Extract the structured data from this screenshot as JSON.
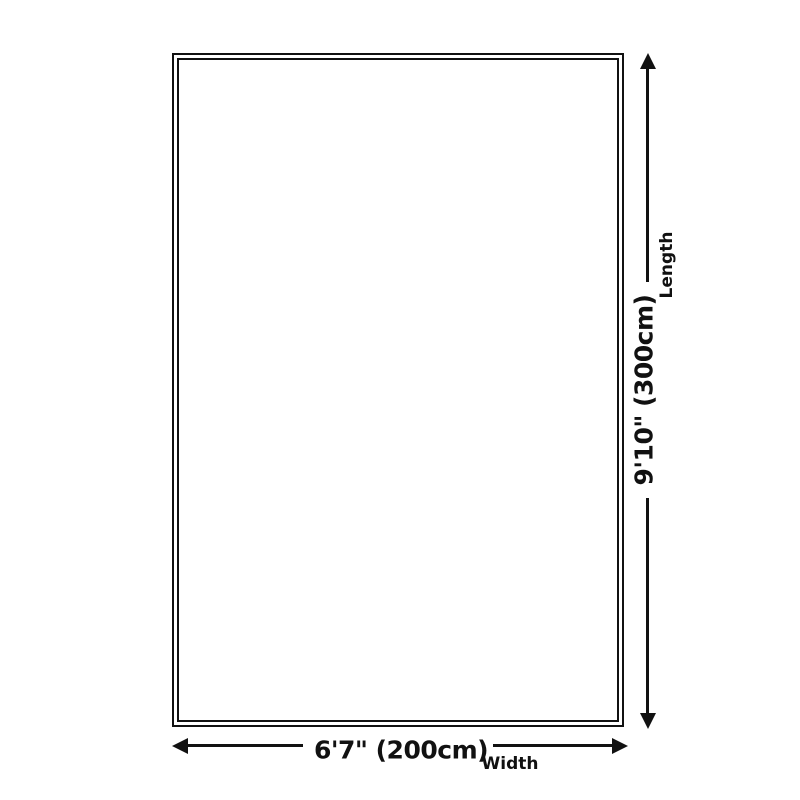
{
  "diagram": {
    "length": {
      "value": "9'10\" (300cm)",
      "label": "Length"
    },
    "width": {
      "value": "6'7\" (200cm)",
      "label": "Width"
    },
    "colors": {
      "line": "#111111",
      "background": "#ffffff"
    },
    "icons": {
      "arrow_up": "arrow-up-icon",
      "arrow_down": "arrow-down-icon",
      "arrow_left": "arrow-left-icon",
      "arrow_right": "arrow-right-icon"
    }
  }
}
